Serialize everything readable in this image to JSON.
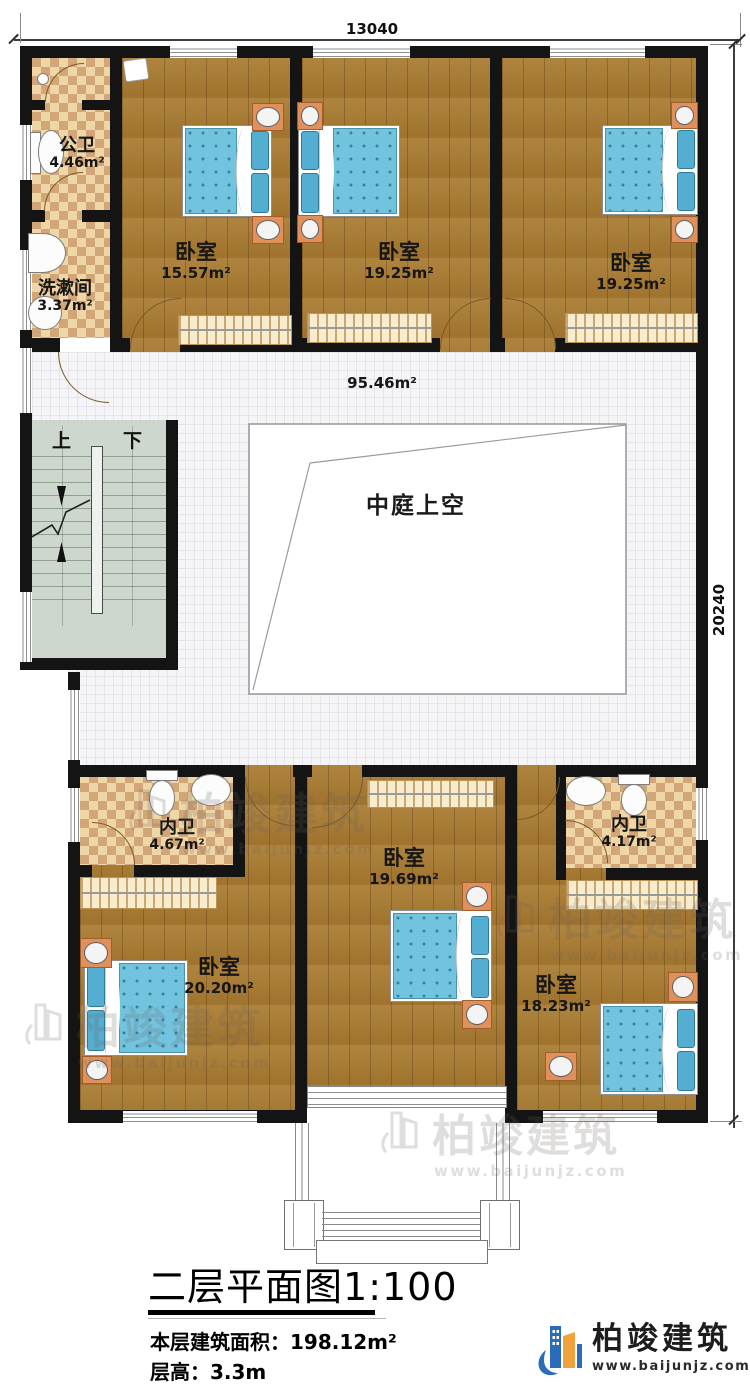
{
  "plan_title": {
    "text": "二层平面图",
    "scale": "1:100"
  },
  "dimensions": {
    "width": "13040",
    "depth": "20240"
  },
  "rooms": {
    "public_bath": {
      "label": "公卫",
      "area": "4.46m²"
    },
    "washroom": {
      "label": "洗漱间",
      "area": "3.37m²"
    },
    "bedroom_top_left": {
      "label": "卧室",
      "area": "15.57m²"
    },
    "bedroom_top_middle": {
      "label": "卧室",
      "area": "19.25m²"
    },
    "bedroom_top_right": {
      "label": "卧室",
      "area": "19.25m²"
    },
    "hallway": {
      "area": "95.46m²"
    },
    "atrium": {
      "label": "中庭上空"
    },
    "bath_bottom_left": {
      "label": "内卫",
      "area": "4.67m²"
    },
    "bedroom_bottom_left": {
      "label": "卧室",
      "area": "20.20m²"
    },
    "bedroom_bottom_middle": {
      "label": "卧室",
      "area": "19.69m²"
    },
    "bath_bottom_right": {
      "label": "内卫",
      "area": "4.17m²"
    },
    "bedroom_bottom_right": {
      "label": "卧室",
      "area": "18.23m²"
    }
  },
  "stairs": {
    "up_label": "上",
    "down_label": "下"
  },
  "footer": {
    "building_area_label": "本层建筑面积：",
    "building_area_value": "198.12m²",
    "floor_height_label": "层高：",
    "floor_height_value": "3.3m"
  },
  "brand": {
    "name": "柏竣建筑",
    "url": "www.baijunjz.com"
  },
  "colors": {
    "wall": "#141414",
    "wood_floor": "#a87a30",
    "bath_tile": "#e9cc96",
    "hall_tile": "#f4f4f6",
    "stair": "#cdd7cd",
    "bed_blue": "#72c3de",
    "logo_blue": "#2b6cb8",
    "logo_orange": "#f0a23c"
  }
}
